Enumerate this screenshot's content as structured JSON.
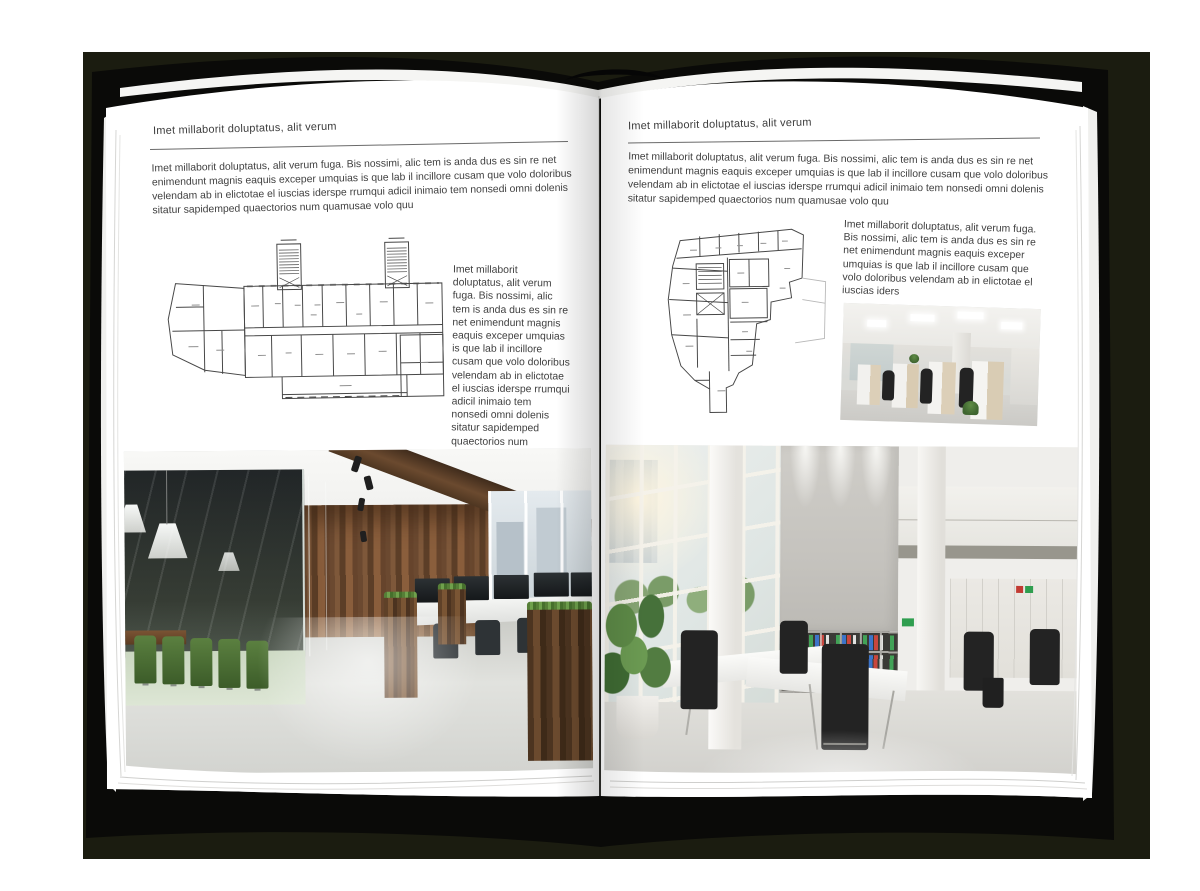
{
  "palette": {
    "backdrop": "#1b1c10",
    "cover": "#0a0a08",
    "page": "#ffffff",
    "text": "#3f3f3f"
  },
  "left_page": {
    "header": "Imet millaborit doluptatus, alit verum",
    "intro": "Imet millaborit doluptatus, alit verum fuga. Bis nossimi, alic tem is anda dus es sin re net enimendunt magnis eaquis exceper umquias is que lab il incillore cusam que volo doloribus velendam ab in elictotae el iuscias iderspe rrumqui adicil inimaio tem nonsedi omni dolenis sitatur sapidemped quaectorios num quamusae volo quu",
    "caption": "Imet millaborit doluptatus, alit verum fuga. Bis nossimi, alic tem is anda dus es sin re net enimendunt magnis eaquis exceper umquias is que lab il incillore cusam que volo doloribus velendam ab in elictotae el iuscias iderspe rrumqui adicil inimaio tem nonsedi omni dolenis sitatur sapidemped quaectorios num quamusae volo quu"
  },
  "right_page": {
    "header": "Imet millaborit doluptatus, alit verum",
    "intro": "Imet millaborit doluptatus, alit verum fuga. Bis nossimi, alic tem is anda dus es sin re net enimendunt magnis eaquis exceper umquias is que lab il incillore cusam que volo doloribus velendam ab in elictotae el iuscias iderspe rrumqui adicil inimaio tem nonsedi omni dolenis sitatur sapidemped quaectorios num quamusae volo quu",
    "caption": "Imet millaborit doluptatus, alit verum fuga. Bis nossimi, alic tem is anda dus es sin re net enimendunt magnis eaquis exceper umquias is que lab il incillore cusam que volo doloribus velendam ab in elictotae el iuscias iders"
  }
}
